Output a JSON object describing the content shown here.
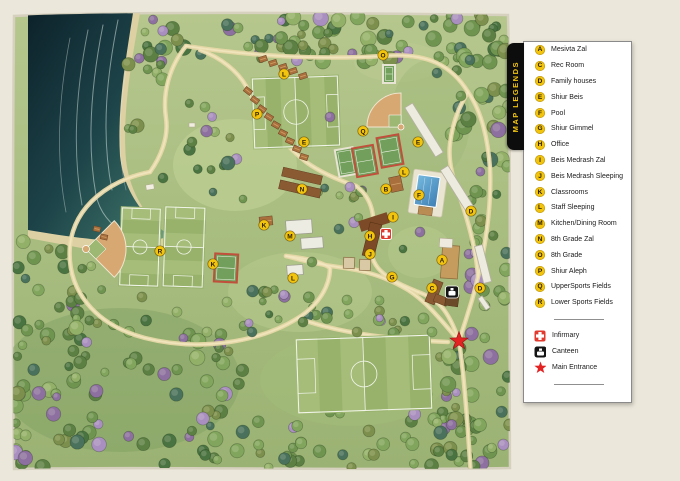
{
  "legend": {
    "banner": "MAP LEGENDS",
    "items": [
      {
        "letter": "A",
        "label": "Mesivta Zal"
      },
      {
        "letter": "C",
        "label": "Rec Room"
      },
      {
        "letter": "D",
        "label": "Family houses"
      },
      {
        "letter": "E",
        "label": "Shiur Beis"
      },
      {
        "letter": "F",
        "label": "Pool"
      },
      {
        "letter": "G",
        "label": "Shiur Gimmel"
      },
      {
        "letter": "H",
        "label": "Office"
      },
      {
        "letter": "I",
        "label": "Beis Medrash Zal"
      },
      {
        "letter": "J",
        "label": "Beis Medrash Sleeping"
      },
      {
        "letter": "K",
        "label": "Classrooms"
      },
      {
        "letter": "L",
        "label": "Staff Sleeping"
      },
      {
        "letter": "M",
        "label": "Kitchen/Dining Room"
      },
      {
        "letter": "N",
        "label": "8th Grade Zal"
      },
      {
        "letter": "O",
        "label": "8th Grade"
      },
      {
        "letter": "P",
        "label": "Shiur Aleph"
      },
      {
        "letter": "Q",
        "label": "UpperSports Fields"
      },
      {
        "letter": "R",
        "label": "Lower Sports Fields"
      }
    ],
    "special_items": [
      {
        "icon": "infirmary-cross",
        "label": "Infirmary"
      },
      {
        "icon": "canteen",
        "label": "Canteen"
      },
      {
        "icon": "entrance-star",
        "label": "Main Entrance"
      }
    ]
  },
  "map": {
    "markers": [
      {
        "letter": "O",
        "x": 383,
        "y": 55
      },
      {
        "letter": "L",
        "x": 284,
        "y": 74
      },
      {
        "letter": "P",
        "x": 257,
        "y": 114
      },
      {
        "letter": "Q",
        "x": 363,
        "y": 131
      },
      {
        "letter": "E",
        "x": 304,
        "y": 142
      },
      {
        "letter": "E",
        "x": 418,
        "y": 142
      },
      {
        "letter": "L",
        "x": 404,
        "y": 172
      },
      {
        "letter": "B",
        "x": 386,
        "y": 189
      },
      {
        "letter": "N",
        "x": 302,
        "y": 189
      },
      {
        "letter": "F",
        "x": 419,
        "y": 195
      },
      {
        "letter": "D",
        "x": 471,
        "y": 211
      },
      {
        "letter": "I",
        "x": 393,
        "y": 217
      },
      {
        "letter": "K",
        "x": 264,
        "y": 225
      },
      {
        "letter": "H",
        "x": 370,
        "y": 236
      },
      {
        "letter": "M",
        "x": 290,
        "y": 236
      },
      {
        "letter": "R",
        "x": 160,
        "y": 251
      },
      {
        "letter": "J",
        "x": 370,
        "y": 254
      },
      {
        "letter": "A",
        "x": 442,
        "y": 260
      },
      {
        "letter": "K",
        "x": 213,
        "y": 264
      },
      {
        "letter": "G",
        "x": 392,
        "y": 277
      },
      {
        "letter": "L",
        "x": 293,
        "y": 278
      },
      {
        "letter": "C",
        "x": 432,
        "y": 288
      },
      {
        "letter": "D",
        "x": 480,
        "y": 288
      }
    ],
    "special_markers": [
      {
        "type": "infirmary",
        "x": 386,
        "y": 234
      },
      {
        "type": "canteen",
        "x": 452,
        "y": 292
      },
      {
        "type": "main-entrance",
        "x": 459,
        "y": 341
      }
    ],
    "colors": {
      "legend_yellow": "#F2C40E",
      "infirmary_red": "#E23A2E",
      "entrance_star_red": "#E32222",
      "water_dark": "#14323C",
      "grass": "#A8BF80",
      "road_tan": "#E7D8A8",
      "court_red": "#C0503C",
      "pool_blue": "#4E93C4",
      "cabin_brown": "#A9703D",
      "panel_bg": "#FFFFFF",
      "banner_bg": "#0D0D0D"
    }
  }
}
